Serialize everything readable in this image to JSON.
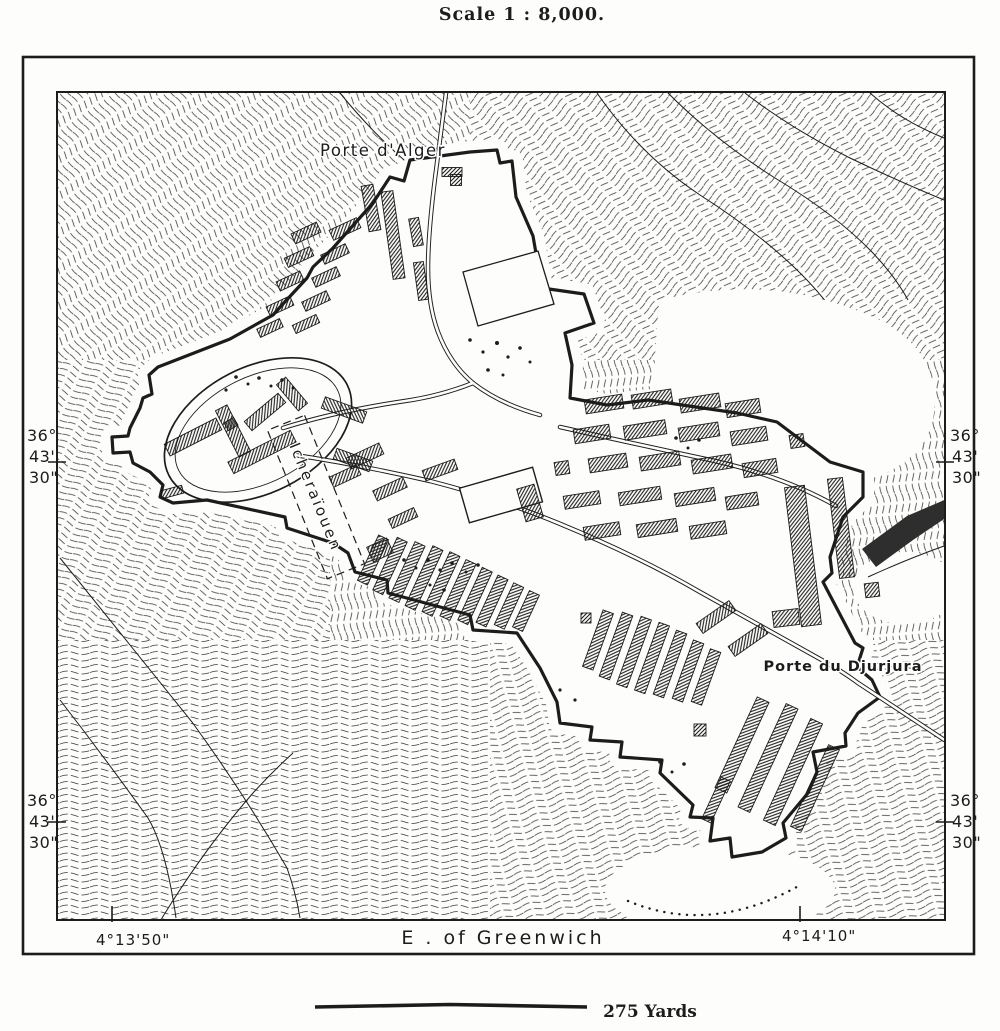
{
  "title": "Scale 1 : 8,000.",
  "map": {
    "labels": {
      "gate_north": "Porte d'Alger",
      "district": "Icheraïouen",
      "gate_southeast": "Porte du Djurjura"
    }
  },
  "frame": {
    "latitude": {
      "deg": "36°",
      "min": "43'",
      "sec": "30\""
    },
    "longitude_left": "4°13'50\"",
    "longitude_center": "E . of Greenwich",
    "longitude_right": "4°14'10\""
  },
  "scale_bar": {
    "label": "275 Yards"
  },
  "colors": {
    "ink": "#1c1c1c",
    "paper": "#fdfdfb",
    "hachure": "#3a3a3a",
    "ravine_dark": "#2e2e2e"
  }
}
